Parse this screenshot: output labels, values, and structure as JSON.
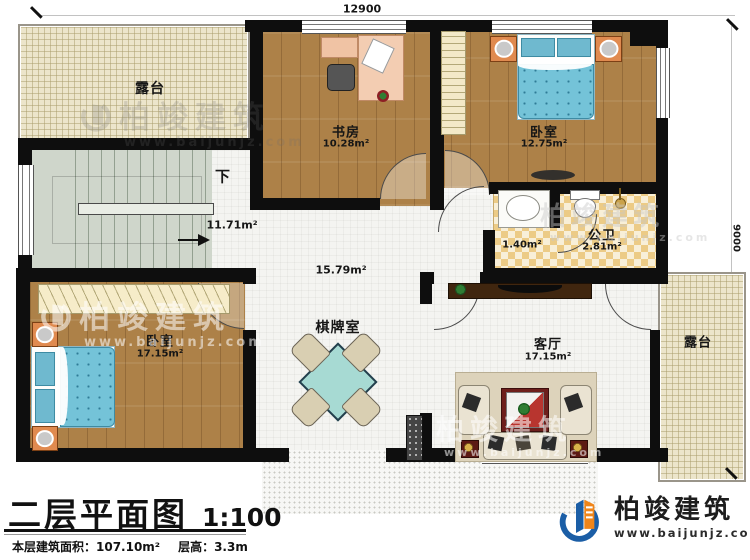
{
  "dimensions": {
    "top": "12900",
    "right": "9000"
  },
  "rooms": {
    "terrace_top": {
      "name": "露台"
    },
    "stairwell": {
      "down": "下",
      "area": "11.71m²"
    },
    "study": {
      "name": "书房",
      "area": "10.28m²"
    },
    "bedroom_top": {
      "name": "卧室",
      "area": "12.75m²"
    },
    "bathroom": {
      "name": "公卫",
      "area": "2.81m²",
      "vanity_area": "1.40m²"
    },
    "hall": {
      "area": "15.79m²"
    },
    "chess_room": {
      "name": "棋牌室"
    },
    "bedroom_left": {
      "name": "卧室",
      "area": "17.15m²"
    },
    "living_room": {
      "name": "客厅",
      "area": "17.15m²"
    },
    "terrace_right": {
      "name": "露台"
    }
  },
  "title_block": {
    "title": "二层平面图",
    "scale": "1:100",
    "floor_area_label": "本层建筑面积：107.10m²",
    "floor_height_label": "层高：3.3m"
  },
  "brand": {
    "name": "柏竣建筑",
    "website": "www.baijunjz.com"
  },
  "watermark": {
    "name": "柏竣建筑",
    "website": "www.baijunjz.com"
  },
  "colors": {
    "wall": "#0e0e0e",
    "wood": "#ad8148",
    "terrace": "#ece5cb",
    "stairs": "#cfd6cb",
    "tile_dark": "#eccb86",
    "tile_light": "#f8efd8",
    "bed": "#74c3d8",
    "brand_blue": "#1b5ea6",
    "brand_orange": "#f08519"
  }
}
